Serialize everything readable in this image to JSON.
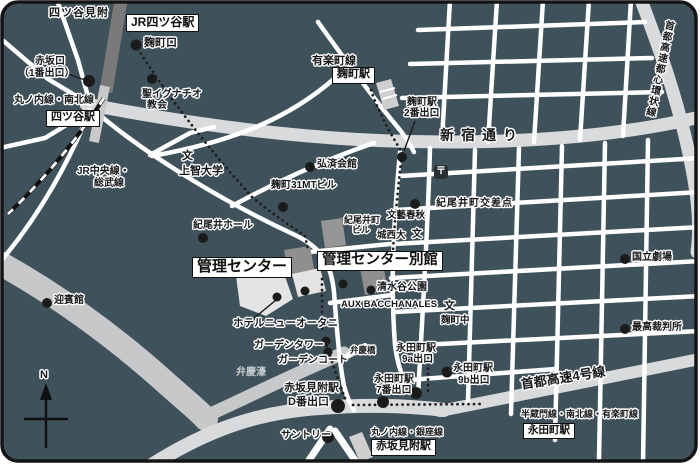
{
  "colors": {
    "background": "#3F525B",
    "street": "#FFFFFF",
    "major_road": "#D9DADB",
    "moat": "#C6C8C9",
    "rail_band": "#7A7A7A",
    "building": "#8F8F8F",
    "building_light": "#E4E4E4",
    "ink": "#141414",
    "label_halo": "#FFFFFF"
  },
  "map": {
    "stations": {
      "jr_yotsuya": "JR四ツ谷駅",
      "yotsuya": "四ツ谷駅",
      "kojimachi": "麹町駅",
      "nagatacho": "永田町駅",
      "akasaka_mitsuke": "赤坂見附駅"
    },
    "destinations": {
      "center": "管理センター",
      "annex": "管理センター別館"
    },
    "railways": {
      "marunouchi_namboku": "丸ノ内線・南北線",
      "jr_chuo_1": "JR中央線・",
      "jr_chuo_2": "総武線",
      "yurakucho": "有楽町線",
      "hanzomon_namboku_yurakucho": "半蔵門線・南北線・有楽町線",
      "marunouchi_ginza": "丸ノ内線・銀座線"
    },
    "roads": {
      "shinjuku_dori": "新宿通り",
      "shuto_4": "首都高速4号線",
      "shuto_kanjo": "首都高速都心環状線"
    },
    "exits": {
      "kojimachi_guchi": "麹町口",
      "akasaka_guchi_1": "赤坂口",
      "akasaka_guchi_2": "（1番出口）",
      "kojimachi_exit2_1": "麹町駅",
      "kojimachi_exit2_2": "2番出口",
      "nagatacho_9a_1": "永田町駅",
      "nagatacho_9a_2": "9a出口",
      "nagatacho_9b_1": "永田町駅",
      "nagatacho_9b_2": "9b出口",
      "nagatacho_7_1": "永田町駅",
      "nagatacho_7_2": "7番出口",
      "akasaka_d_1": "赤坂見附駅",
      "akasaka_d_2": "D番出口"
    },
    "places": {
      "yotsuya_mitsuke": "四ツ谷見附",
      "st_ignatius_1": "聖イグナチオ",
      "st_ignatius_2": "教会",
      "sophia_univ": "上智大学",
      "kosai_kaikan": "弘済会館",
      "kojimachi_31mt": "麹町31MTビル",
      "kioi_hall": "紀尾井ホール",
      "kioicho_bldg_1": "紀尾井町",
      "kioicho_bldg_2": "ビル",
      "kioicho_kosaten": "紀尾井町交差点",
      "bungei_shunju": "文藝春秋",
      "josai_univ": "城西大",
      "kojimachi_jhs": "麹町中",
      "shimizudani_park": "清水谷公園",
      "aux_bacchanales": "AUX BACCHANALES",
      "hotel_new_otani": "ホテルニューオータニ",
      "garden_tower": "ガーデンタワー",
      "garden_court": "ガーデンコート",
      "benkei_bori": "弁慶濠",
      "benkei_bashi": "弁慶橋",
      "suntory": "サントリー",
      "national_theatre": "国立劇場",
      "supreme_court": "最高裁判所",
      "geihinkan": "迎賓館"
    },
    "symbols": {
      "school_mark": "文",
      "post_mark": "〒",
      "north_mark": "N"
    }
  }
}
